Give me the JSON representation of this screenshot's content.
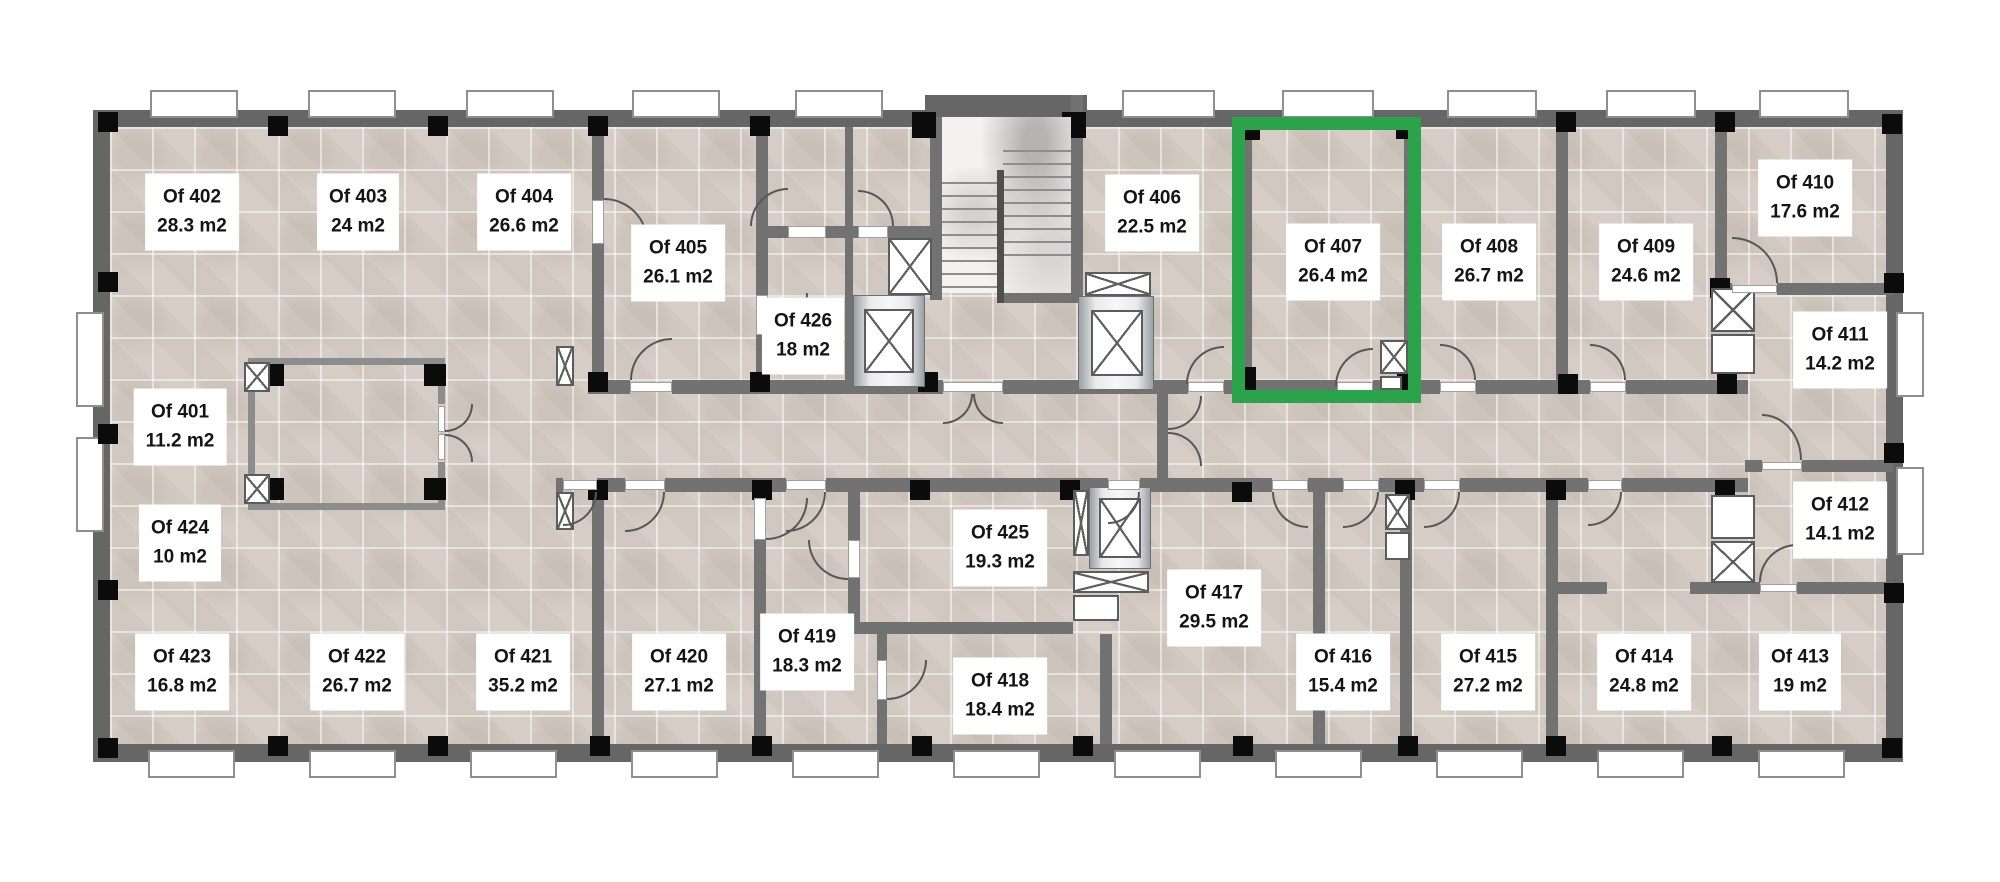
{
  "plan": {
    "type": "office-floor-plan",
    "highlight_color": "#2ba34a",
    "selected_room": "Of 407",
    "area_unit": "m2",
    "rooms": [
      {
        "name": "Of 401",
        "area": "11.2 m2"
      },
      {
        "name": "Of 402",
        "area": "28.3 m2"
      },
      {
        "name": "Of 403",
        "area": "24 m2"
      },
      {
        "name": "Of 404",
        "area": "26.6 m2"
      },
      {
        "name": "Of 405",
        "area": "26.1 m2"
      },
      {
        "name": "Of 406",
        "area": "22.5 m2"
      },
      {
        "name": "Of 407",
        "area": "26.4 m2"
      },
      {
        "name": "Of 408",
        "area": "26.7 m2"
      },
      {
        "name": "Of 409",
        "area": "24.6 m2"
      },
      {
        "name": "Of 410",
        "area": "17.6 m2"
      },
      {
        "name": "Of 411",
        "area": "14.2 m2"
      },
      {
        "name": "Of 412",
        "area": "14.1 m2"
      },
      {
        "name": "Of 413",
        "area": "19 m2"
      },
      {
        "name": "Of 414",
        "area": "24.8 m2"
      },
      {
        "name": "Of 415",
        "area": "27.2 m2"
      },
      {
        "name": "Of 416",
        "area": "15.4 m2"
      },
      {
        "name": "Of 417",
        "area": "29.5 m2"
      },
      {
        "name": "Of 418",
        "area": "18.4 m2"
      },
      {
        "name": "Of 419",
        "area": "18.3 m2"
      },
      {
        "name": "Of 420",
        "area": "27.1 m2"
      },
      {
        "name": "Of 421",
        "area": "35.2 m2"
      },
      {
        "name": "Of 422",
        "area": "26.7 m2"
      },
      {
        "name": "Of 423",
        "area": "16.8 m2"
      },
      {
        "name": "Of 424",
        "area": "10 m2"
      },
      {
        "name": "Of 425",
        "area": "19.3 m2"
      },
      {
        "name": "Of 426",
        "area": "18 m2"
      }
    ]
  }
}
